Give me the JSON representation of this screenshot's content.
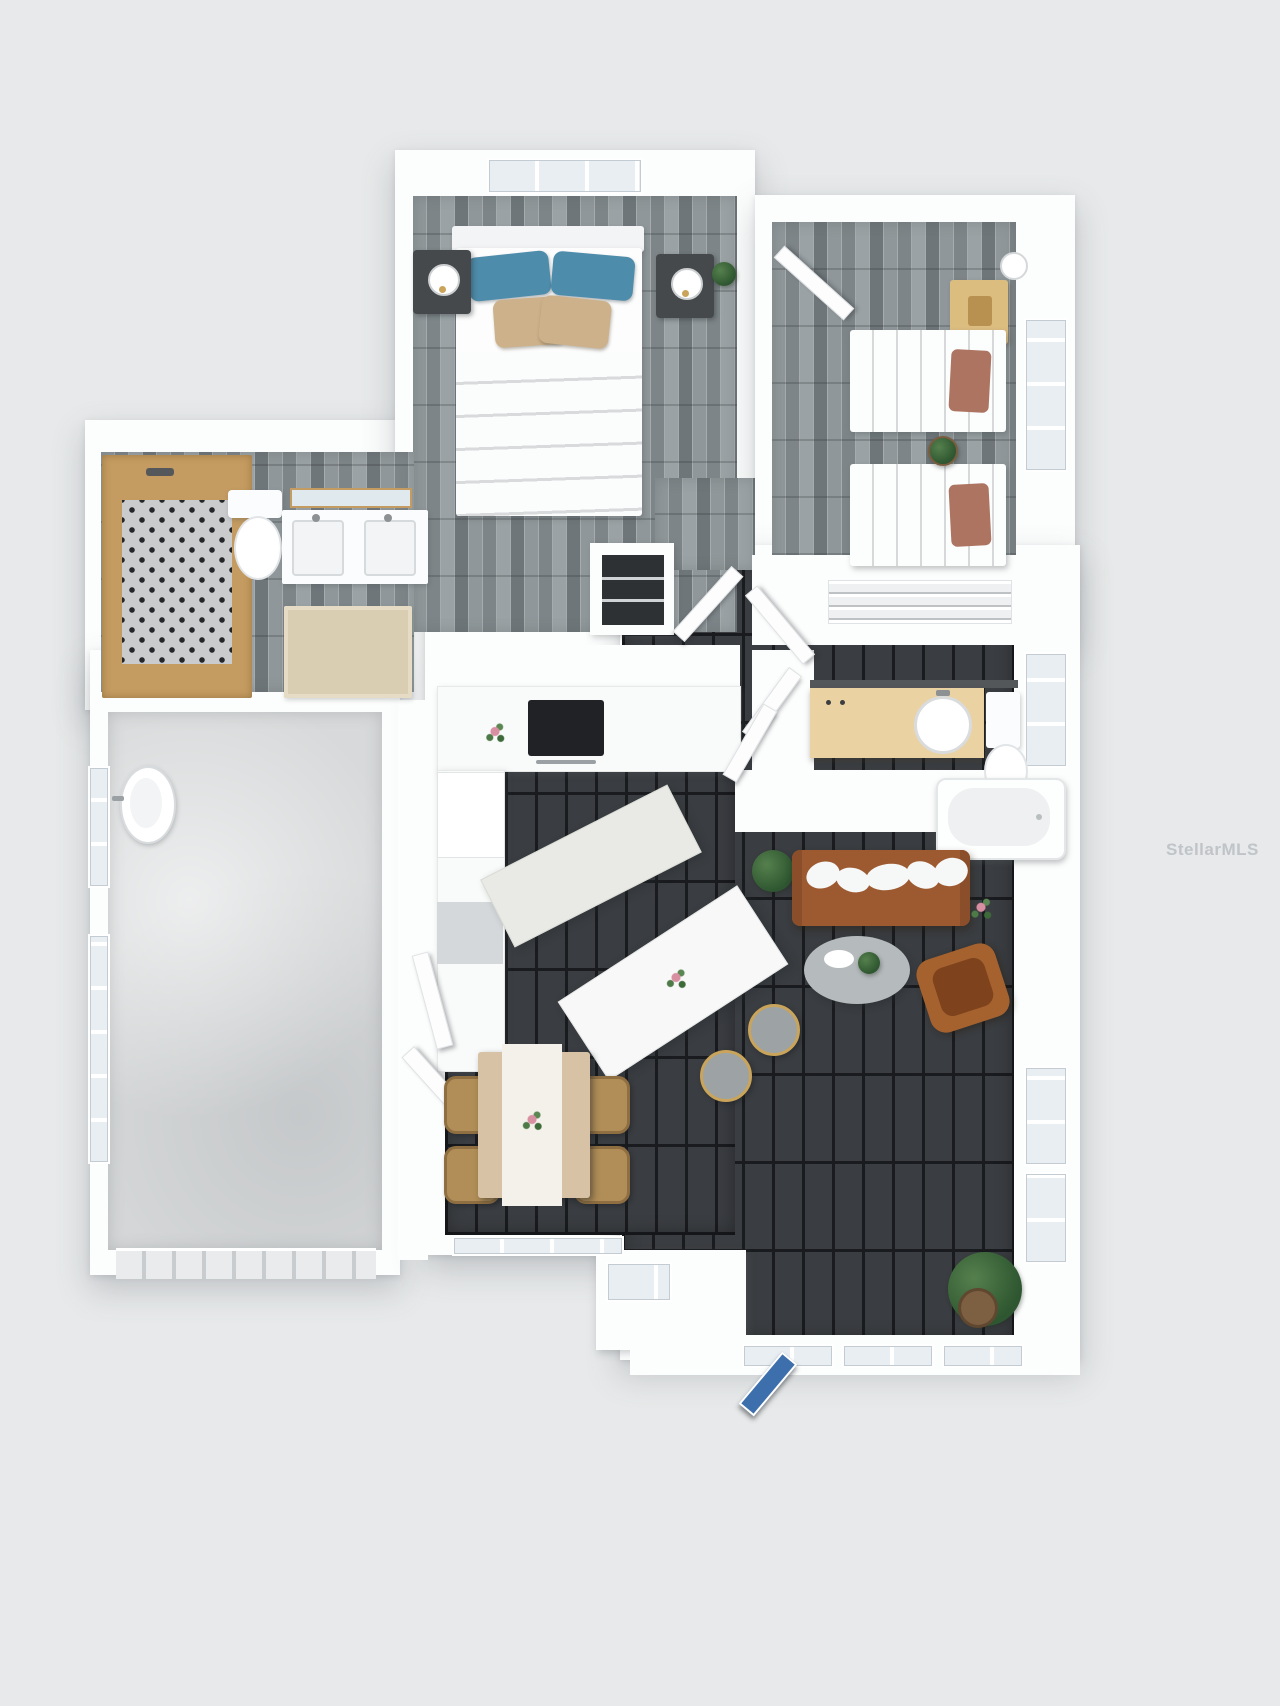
{
  "watermark": {
    "text": "StellarMLS"
  },
  "scene": {
    "type": "3d_floor_plan_top_view",
    "rooms": [
      {
        "name": "primary-bedroom",
        "floor": "gray-wood-planks",
        "furniture": [
          "double-bed-white-duvet",
          "blue-pillows-x2",
          "tan-pillows-x2",
          "nightstand-left-with-lamp",
          "nightstand-right-with-lamp",
          "plant",
          "closet-with-shelves",
          "window-top"
        ]
      },
      {
        "name": "primary-bathroom",
        "floor": "gray-wood-planks",
        "furniture": [
          "wood-framed-mosaic-shower",
          "toilet",
          "double-sink-vanity",
          "wood-framed-mirror",
          "beige-rug"
        ]
      },
      {
        "name": "bedroom-2",
        "floor": "gray-wood-planks",
        "furniture": [
          "twin-bed-1-rust-pillow",
          "twin-bed-2-rust-pillow",
          "tan-desk",
          "white-sphere-lamp",
          "plant",
          "open-door",
          "windows-right"
        ]
      },
      {
        "name": "bathroom-2",
        "floor": "dark-tile",
        "furniture": [
          "tan-vanity-round-sink",
          "toilet",
          "bathtub",
          "wire-shelf-closet",
          "open-doors"
        ]
      },
      {
        "name": "kitchen",
        "floor": "dark-tile",
        "furniture": [
          "l-shaped-counter",
          "black-cooktop",
          "red-flowers",
          "appliance",
          "prep-island",
          "bar-island-with-flowers",
          "bar-stools-x2"
        ]
      },
      {
        "name": "dining-area",
        "floor": "dark-tile",
        "furniture": [
          "dining-table",
          "white-table-runner",
          "flower-centerpiece",
          "wicker-chairs-x4",
          "open-door",
          "window-bottom"
        ]
      },
      {
        "name": "living-room",
        "floor": "dark-tile",
        "furniture": [
          "brown-sofa",
          "white-throw-pillows-x5",
          "oval-coffee-table",
          "brown-accent-chair",
          "plants-x2"
        ]
      },
      {
        "name": "bonus-room",
        "floor": "dark-tile",
        "furniture": [
          "potted-plant",
          "entry-vestibule",
          "blue-front-door",
          "windows-bottom",
          "windows-right"
        ]
      },
      {
        "name": "garage",
        "floor": "concrete",
        "furniture": [
          "utility-sink",
          "garage-door",
          "windows-left"
        ]
      }
    ]
  },
  "colors": {
    "background": "#e7e9ea",
    "wall_white": "#fcfdfd",
    "plank_floor": "#949a9d",
    "dark_tile": "#3a3d41",
    "tile_grout": "#191b1e",
    "concrete": "#d7d9da",
    "shower_wood_frame": "#c49b60",
    "rug_beige": "#d9cdb2",
    "sofa_brown": "#9d5a31",
    "accent_chair_brown": "#a5622f",
    "pillow_blue": "#4e8cab",
    "pillow_tan": "#cdb18a",
    "pillow_rust": "#ad7462",
    "vanity_tan": "#ead2a2",
    "door_blue": "#3e6fad",
    "stool_gray": "#9da3a5",
    "stool_gold": "#c9a45a",
    "plant_green": "#3e6a3a",
    "window_glass": "#e8eef2"
  }
}
